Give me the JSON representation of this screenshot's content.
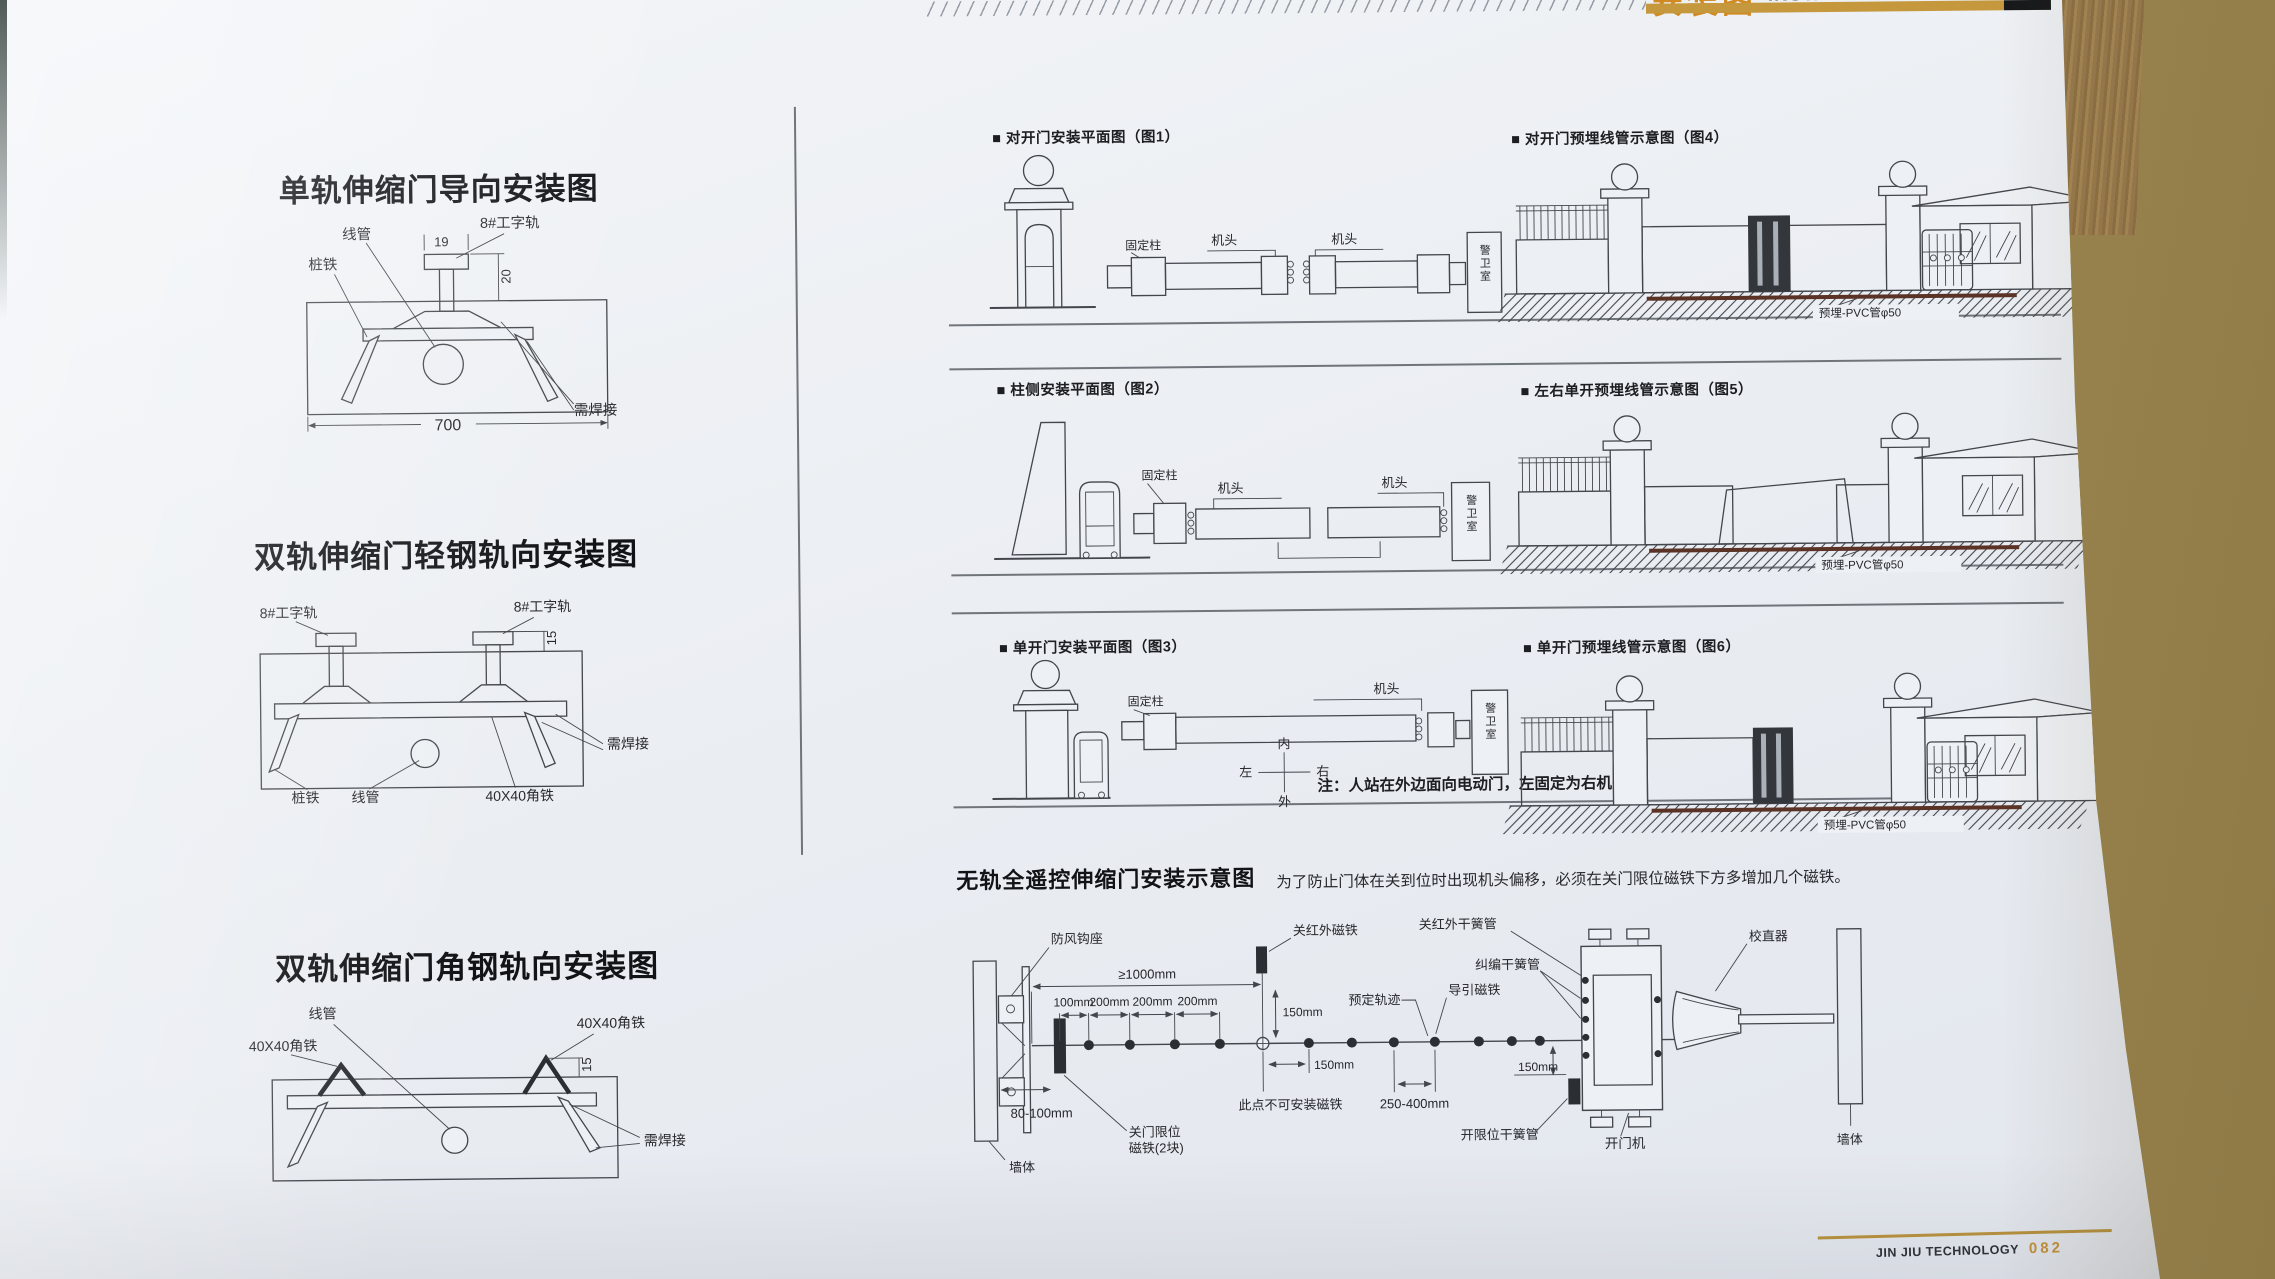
{
  "header": {
    "title_cn": "安装图",
    "title_en": "INSTALLATION DRAWINGS"
  },
  "left": {
    "d1": {
      "title": "单轨伸缩门导向安装图",
      "conduit": "线管",
      "rail": "8#工字轨",
      "stake": "桩铁",
      "weld": "需焊接",
      "dim_w": "19",
      "dim_h": "20",
      "dim_base": "700"
    },
    "d2": {
      "title": "双轨伸缩门轻钢轨向安装图",
      "rail_l": "8#工字轨",
      "rail_r": "8#工字轨",
      "dim_h": "15",
      "weld": "需焊接",
      "stake": "桩铁",
      "conduit": "线管",
      "angle": "40X40角铁"
    },
    "d3": {
      "title": "双轨伸缩门角钢轨向安装图",
      "conduit": "线管",
      "angle_l": "40X40角铁",
      "angle_r": "40X40角铁",
      "dim_h": "15",
      "weld": "需焊接"
    }
  },
  "figs": {
    "fig1": {
      "title": "■ 对开门安装平面图（图1）",
      "fixed_post": "固定柱",
      "head_l": "机头",
      "head_r": "机头",
      "guard_room": "警卫室"
    },
    "fig4": {
      "title": "■ 对开门预埋线管示意图（图4）",
      "pvc": "预埋-PVC管φ50"
    },
    "fig2": {
      "title": "■ 柱侧安装平面图（图2）",
      "fixed_post": "固定柱",
      "head_l": "机头",
      "head_r": "机头",
      "guard_room": "警卫室"
    },
    "fig5": {
      "title": "■ 左右单开预埋线管示意图（图5）",
      "pvc": "预埋-PVC管φ50"
    },
    "fig3": {
      "title": "■ 单开门安装平面图（图3）",
      "fixed_post": "固定柱",
      "head": "机头",
      "guard_room": "警卫室",
      "compass_n": "内",
      "compass_s": "外",
      "compass_w": "左",
      "compass_e": "右",
      "note": "注：人站在外边面向电动门，左固定为右机头"
    },
    "fig6": {
      "title": "■ 单开门预埋线管示意图（图6）",
      "pvc": "预埋-PVC管φ50"
    }
  },
  "bottom": {
    "title": "无轨全遥控伸缩门安装示意图",
    "note": "为了防止门体在关到位时出现机头偏移，必须在关门限位磁铁下方多增加几个磁铁。",
    "wall_l": "墙体",
    "wall_r": "墙体",
    "hook": "防风钩座",
    "close_ir_magnet": "关红外磁铁",
    "close_ir_reed": "关红外干簧管",
    "rectify_reed": "纠编干簧管",
    "guide_magnet": "导引磁铁",
    "planned_track": "预定轨迹",
    "no_magnet_point": "此点不可安装磁铁",
    "close_limit_1": "关门限位",
    "close_limit_2": "磁铁(2块)",
    "open_limit_reed": "开限位干簧管",
    "opener": "开门机",
    "straightener": "校直器",
    "d_1000": "≥1000mm",
    "d_100": "100mm",
    "d_200a": "200mm",
    "d_200b": "200mm",
    "d_200c": "200mm",
    "d_150a": "150mm",
    "d_150b": "150mm",
    "d_150c": "150mm",
    "d_80": "80-100mm",
    "d_250": "250-400mm"
  },
  "footer": {
    "brand": "JIN JIU TECHNOLOGY",
    "page": "082"
  },
  "colors": {
    "accent_gold": "#c5983e",
    "accent_orange": "#d18a21",
    "pvc_pipe": "#5a3326",
    "ink": "#43464c",
    "paper": "#edf0f4",
    "background_tan": "#a89258"
  }
}
